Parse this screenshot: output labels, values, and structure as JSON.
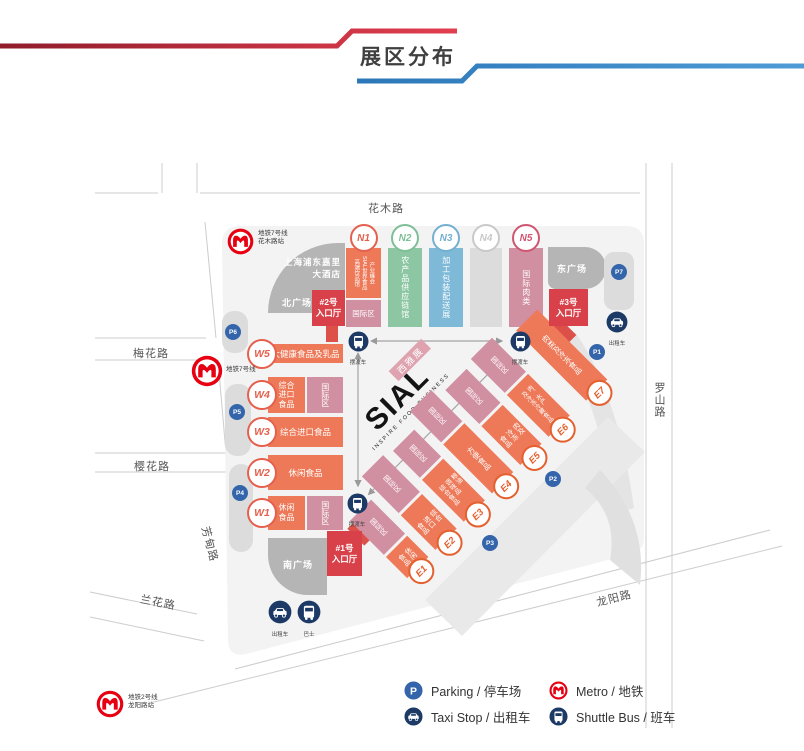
{
  "header": {
    "title": "展区分布"
  },
  "streets": {
    "huamu": "花木路",
    "meihua": "梅花路",
    "yinghua": "樱花路",
    "lanhua": "兰花路",
    "fangdian": "芳甸路",
    "luoshan": "罗山路",
    "longyang": "龙阳路"
  },
  "metro_stations": {
    "line7_huamu": "地铁7号线\n花木路站",
    "line7": "地铁7号线",
    "line2_longyang": "地铁2号线\n龙阳路站"
  },
  "venue": {
    "hotel": "上海浦东嘉里\n大酒店",
    "north_plaza": "北广场",
    "east_plaza": "东广场",
    "south_plaza": "南广场"
  },
  "entrances": {
    "e1": "#1号\n入口厅",
    "e2": "#2号\n入口厅",
    "e3": "#3号\n入口厅"
  },
  "logo": {
    "name": "SIAL",
    "tagline": "INSPIRE FOOD BUSINESS",
    "badge": "西雅展"
  },
  "halls": {
    "north": [
      {
        "id": "N1",
        "labels": [
          "高端饮品馆",
          "SIAL世界食品",
          "产业峰会"
        ],
        "sub": "国际区"
      },
      {
        "id": "N2",
        "label": "农产品供应链馆"
      },
      {
        "id": "N3",
        "label": "加工包装配送展"
      },
      {
        "id": "N4",
        "label": ""
      },
      {
        "id": "N5",
        "label": "国际肉类"
      }
    ],
    "west": [
      {
        "id": "W5",
        "label": "大健康食品及乳品"
      },
      {
        "id": "W4",
        "label": "综合\n进口\n食品",
        "sub": "国际区"
      },
      {
        "id": "W3",
        "label": "综合进口食品"
      },
      {
        "id": "W2",
        "label": "休闲食品"
      },
      {
        "id": "W1",
        "label": "休闲\n食品",
        "sub": "国际区"
      }
    ],
    "east": [
      {
        "id": "E1",
        "label": "休闲\n食品",
        "sub": "国际区"
      },
      {
        "id": "E2",
        "label": "综合\n进口\n食品",
        "sub": "国际区"
      },
      {
        "id": "E3",
        "label": "粮油\n调味品\n综合食品",
        "sub": "国际区"
      },
      {
        "id": "E4",
        "label": "方便食品",
        "sub": "国际区"
      },
      {
        "id": "E5",
        "label": "肉及\n冷冻\n食品",
        "sub": "国际区"
      },
      {
        "id": "E6",
        "label": "肉、水产\n及冷冻冷藏食品",
        "sub": "国际区"
      },
      {
        "id": "E7",
        "label": "肉类及冷冻食品"
      }
    ]
  },
  "parking_markers": [
    "P1",
    "P2",
    "P3",
    "P4",
    "P5",
    "P6",
    "P7"
  ],
  "transport": {
    "taxi": "出租车",
    "bus": "巴士",
    "shuttle": "摆渡车"
  },
  "legend": [
    {
      "icon": "parking-icon",
      "label": "Parking / 停车场"
    },
    {
      "icon": "taxi-icon",
      "label": "Taxi Stop / 出租车"
    },
    {
      "icon": "metro-icon",
      "label": "Metro / 地铁"
    },
    {
      "icon": "shuttle-icon",
      "label": "Shuttle Bus / 班车"
    }
  ],
  "colors": {
    "orange": "#ee7958",
    "pink": "#d18fa2",
    "green": "#8cc6a2",
    "blue": "#7fb9d8",
    "hall_gray": "#dcdcdc",
    "entrance_red": "#d8404a",
    "metro_red": "#e60012",
    "navy": "#1d3a67",
    "parking_blue": "#3465ab",
    "line_red": "#c42a40",
    "line_blue": "#2f81c4"
  }
}
